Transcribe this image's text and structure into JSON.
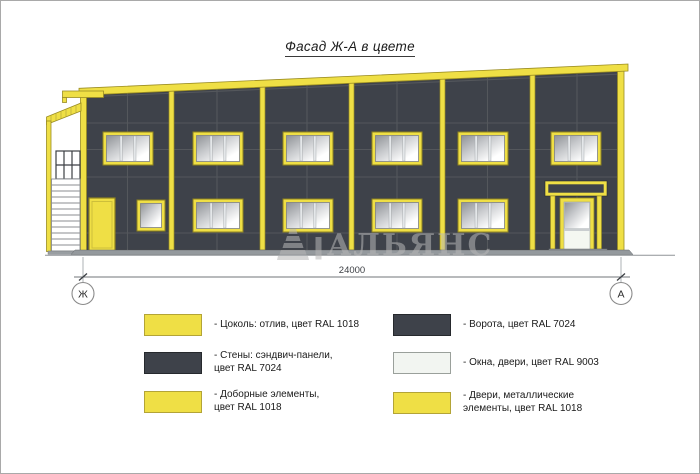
{
  "title": "Фасад Ж-А в цвете",
  "watermark": {
    "text": "АЛЬЯНС"
  },
  "drawing": {
    "dimension_label": "24000",
    "axis_left_label": "Ж",
    "axis_right_label": "А"
  },
  "colors": {
    "yellow": "#EFDF45",
    "dark_gray": "#3E424A",
    "white": "#F2F5F1"
  },
  "legend": {
    "left": [
      {
        "swatch": "yellow",
        "line1": "- Цоколь: отлив, цвет RAL 1018",
        "line2": ""
      },
      {
        "swatch": "dark_gray",
        "line1": "- Стены: сэндвич-панели,",
        "line2": "цвет RAL 7024"
      },
      {
        "swatch": "yellow",
        "line1": "- Доборные элементы,",
        "line2": "цвет RAL 1018"
      }
    ],
    "right": [
      {
        "swatch": "dark_gray",
        "line1": "- Ворота, цвет RAL 7024",
        "line2": ""
      },
      {
        "swatch": "white",
        "line1": "- Окна, двери, цвет RAL 9003",
        "line2": ""
      },
      {
        "swatch": "yellow",
        "line1": "- Двери, металлические",
        "line2": "элементы, цвет RAL 1018"
      }
    ]
  }
}
